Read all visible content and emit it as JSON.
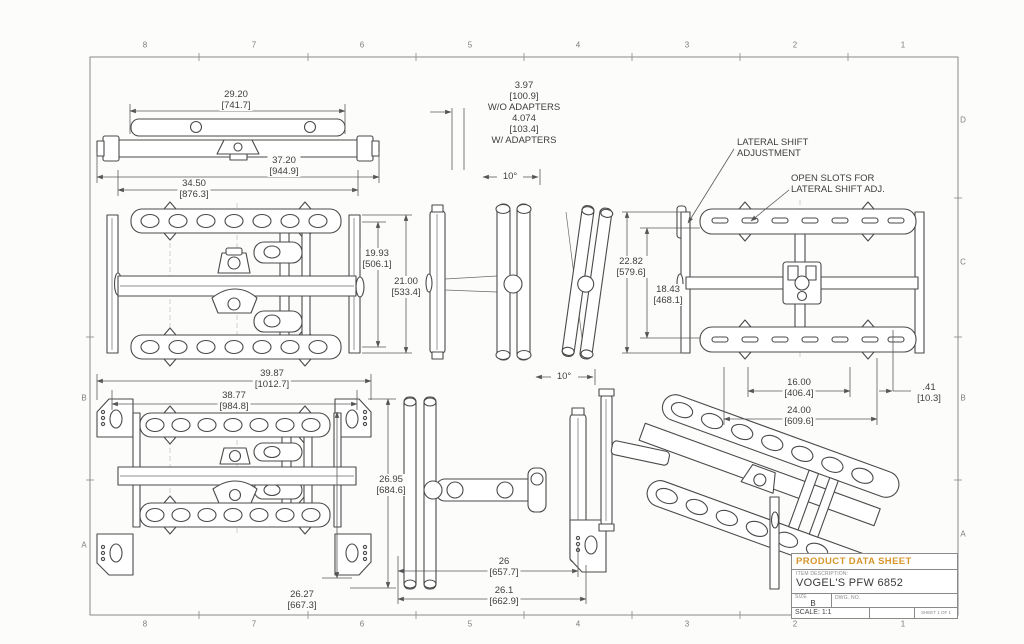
{
  "colors": {
    "accent": "#d6962c",
    "line": "#4a4a4a",
    "background": "#fcfcfb"
  },
  "border": {
    "top": [
      "8",
      "7",
      "6",
      "5",
      "4",
      "3",
      "2",
      "1"
    ],
    "bottom": [
      "8",
      "7",
      "6",
      "5",
      "4",
      "3",
      "2",
      "1"
    ],
    "left": [
      "B",
      "A"
    ],
    "right": [
      "D",
      "C",
      "B",
      "A"
    ]
  },
  "title_block": {
    "header": "PRODUCT DATA SHEET",
    "item_description_label": "ITEM DESCRIPTION:",
    "item_description": "VOGEL'S PFW 6852",
    "size_label": "SIZE",
    "size_value": "B",
    "dwg_label": "DWG. NO.",
    "scale_label": "SCALE: 1:1",
    "sheet_label": "SHEET 1 OF 1"
  },
  "notes": {
    "adapters": {
      "l1": "3.97",
      "l2": "[100.9]",
      "l3": "W/O ADAPTERS",
      "l4": "4.074",
      "l5": "[103.4]",
      "l6": "W/ ADAPTERS"
    },
    "angle_top": "10°",
    "angle_bottom": "10°",
    "lateral_shift_l1": "LATERAL SHIFT",
    "lateral_shift_l2": "ADJUSTMENT",
    "open_slots_l1": "OPEN SLOTS FOR",
    "open_slots_l2": "LATERAL SHIFT ADJ."
  },
  "dims": {
    "w2920": {
      "in": "29.20",
      "mm": "[741.7]"
    },
    "w3720": {
      "in": "37.20",
      "mm": "[944.9]"
    },
    "w3450": {
      "in": "34.50",
      "mm": "[876.3]"
    },
    "h1993": {
      "in": "19.93",
      "mm": "[506.1]"
    },
    "h2100": {
      "in": "21.00",
      "mm": "[533.4]"
    },
    "h2282": {
      "in": "22.82",
      "mm": "[579.6]"
    },
    "h1843": {
      "in": "18.43",
      "mm": "[468.1]"
    },
    "w1600": {
      "in": "16.00",
      "mm": "[406.4]"
    },
    "w2400": {
      "in": "24.00",
      "mm": "[609.6]"
    },
    "w041": {
      "in": ".41",
      "mm": "[10.3]"
    },
    "w3987": {
      "in": "39.87",
      "mm": "[1012.7]"
    },
    "w3877": {
      "in": "38.77",
      "mm": "[984.8]"
    },
    "h2695": {
      "in": "26.95",
      "mm": "[684.6]"
    },
    "h2627": {
      "in": "26.27",
      "mm": "[667.3]"
    },
    "w2600": {
      "in": "26",
      "mm": "[657.7]"
    },
    "w2610": {
      "in": "26.1",
      "mm": "[662.9]"
    }
  }
}
